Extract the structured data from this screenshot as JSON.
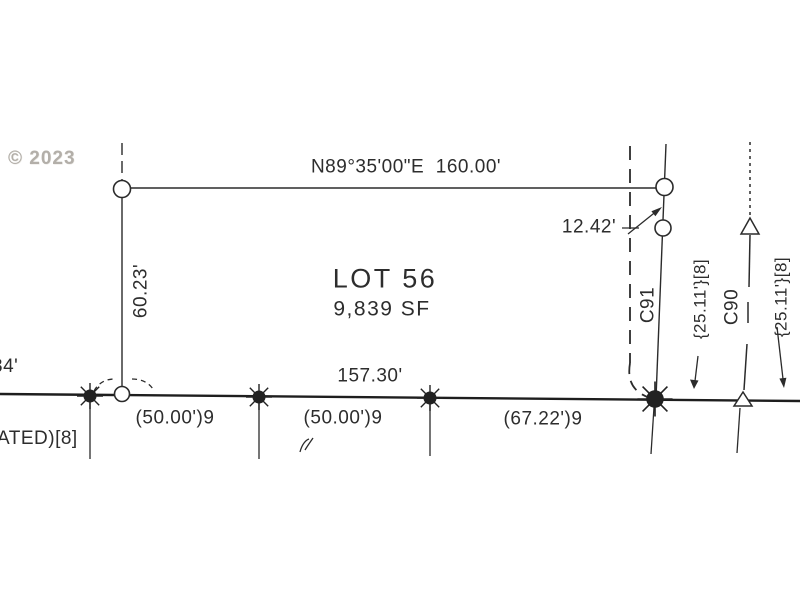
{
  "watermark": {
    "text": "© 2023"
  },
  "colors": {
    "line": "#2b2b2b",
    "street_line": "#1e1e1e",
    "text": "#2d2d2d",
    "watermark": "#b3afa9",
    "background": "#ffffff"
  },
  "lot": {
    "title": "LOT 56",
    "area": "9,839 SF"
  },
  "boundary": {
    "north_bearing_distance": "N89°35'00\"E  160.00'",
    "west_distance": "60.23'",
    "east_jog_distance": "12.42'",
    "south_distance": "157.30'"
  },
  "frontage": {
    "segment_1": "(50.00')9",
    "segment_2": "(50.00')9",
    "segment_3": "(67.22')9"
  },
  "curves": {
    "c91_label": "C91",
    "c90_label": "C90",
    "c91_dim": "{25.11'}[8]",
    "c90_dim": "{25.11'}[8]"
  },
  "edge": {
    "left_top": "34'",
    "left_bottom": "ATED)[8]"
  }
}
